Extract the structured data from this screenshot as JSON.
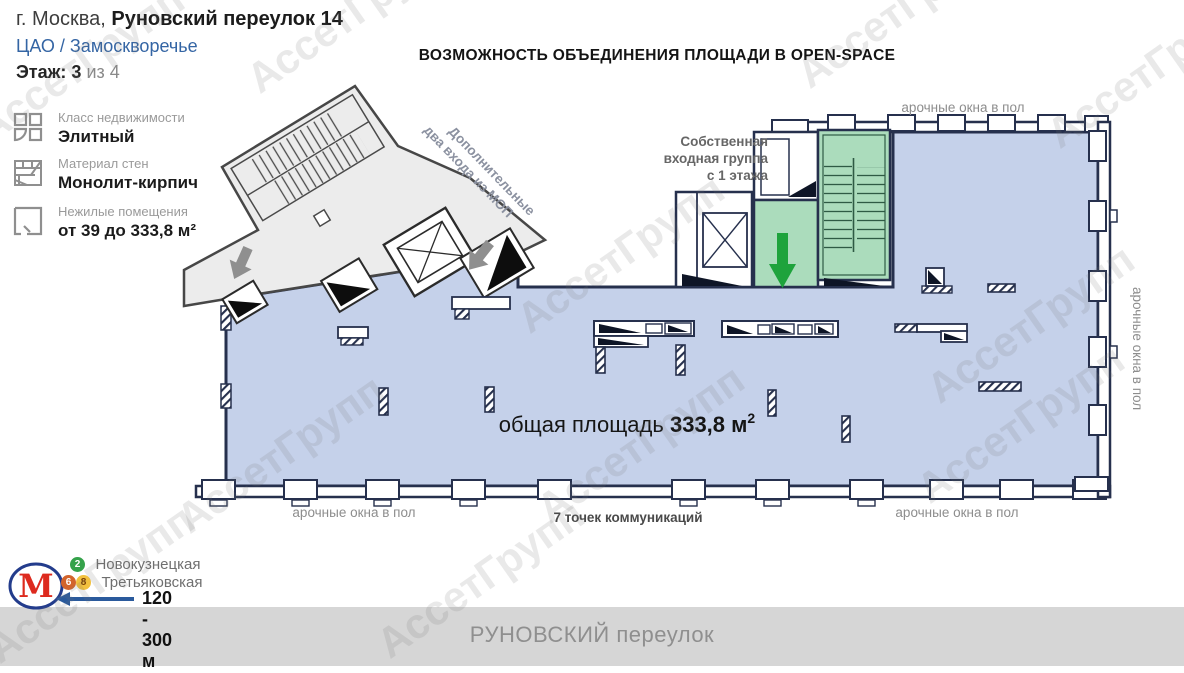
{
  "header": {
    "city": "г. Москва,",
    "address": "Руновский переулок 14",
    "district": "ЦАО / Замоскворечье",
    "floor_label": "Этаж:",
    "floor_current": "3",
    "floor_total": "из 4"
  },
  "sidebar": {
    "items": [
      {
        "label": "Класс недвижимости",
        "value": "Элитный"
      },
      {
        "label": "Материал стен",
        "value": "Монолит-кирпич"
      },
      {
        "label": "Нежилые помещения",
        "value": "от 39 до 333,8 м²"
      }
    ]
  },
  "plan": {
    "headline": "ВОЗМОЖНОСТЬ ОБЪЕДИНЕНИЯ ПЛОЩАДИ В OPEN-SPACE",
    "entrance_line1": "Собственная",
    "entrance_line2": "входная группа",
    "entrance_line3": "с 1 этажа",
    "additional_line1": "Дополнительные",
    "additional_line2": "два входа из МОП",
    "arched_windows": "арочные окна в пол",
    "communications": "7 точек коммуникаций",
    "area_prefix": "общая площадь ",
    "area_value": "333,8 м",
    "area_sup": "2"
  },
  "metro": {
    "logo": "М",
    "stations": [
      {
        "name": "Новокузнецкая",
        "badges": [
          {
            "number": "2",
            "color": "#35a24b"
          }
        ]
      },
      {
        "name": "Третьяковская",
        "badges": [
          {
            "number": "6",
            "color": "#d2642c"
          },
          {
            "number": "8",
            "color": "#f2c13e"
          }
        ]
      }
    ],
    "distance": "120 - 300 м"
  },
  "footer": {
    "street": "РУНОВСКИЙ переулок"
  },
  "watermark": {
    "text": "АссетГрупп"
  },
  "colors": {
    "plan_area_fill": "#c5d1ea",
    "plan_wall": "#26304d",
    "wing_fill": "#ececec",
    "stair_green": "#abdcbc",
    "arrow_green": "#1ea33c",
    "metro_red": "#dd2a1e",
    "metro_blue_border": "#233c8c",
    "district_blue": "#3465a4",
    "footer_bg": "#d6d6d6"
  }
}
